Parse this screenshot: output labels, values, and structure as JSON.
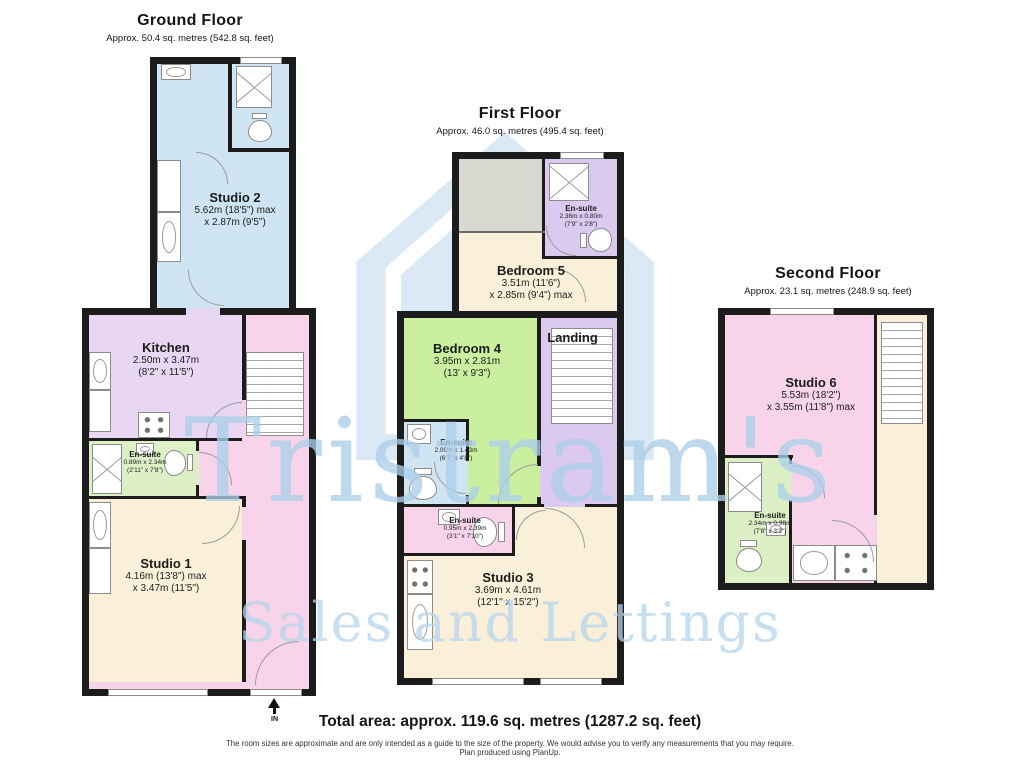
{
  "watermark": {
    "brand": "Tristram's",
    "tagline": "Sales and Lettings",
    "color": "#cde2f3"
  },
  "floors": {
    "ground": {
      "title": "Ground Floor",
      "subtitle": "Approx. 50.4 sq. metres (542.8 sq. feet)",
      "entrance_label": "IN",
      "rooms": {
        "studio2": {
          "name": "Studio 2",
          "dims1": "5.62m (18'5\") max",
          "dims2": "x 2.87m (9'5\")"
        },
        "kitchen": {
          "name": "Kitchen",
          "dims1": "2.50m x 3.47m",
          "dims2": "(8'2\" x 11'5\")"
        },
        "ensuite": {
          "name": "En-suite",
          "dims1": "0.89m x 2.34m",
          "dims2": "(2'11\" x 7'8\")"
        },
        "studio1": {
          "name": "Studio 1",
          "dims1": "4.16m (13'8\") max",
          "dims2": "x 3.47m (11'5\")"
        }
      }
    },
    "first": {
      "title": "First Floor",
      "subtitle": "Approx. 46.0 sq. metres (495.4 sq. feet)",
      "rooms": {
        "ensuite_top": {
          "name": "En-suite",
          "dims1": "2.36m x 0.80m",
          "dims2": "(7'9\" x 2'8\")"
        },
        "bedroom5": {
          "name": "Bedroom 5",
          "dims1": "3.51m (11'6\")",
          "dims2": "x 2.85m (9'4\") max"
        },
        "bedroom4": {
          "name": "Bedroom 4",
          "dims1": "3.95m x 2.81m",
          "dims2": "(13' x 9'3\")"
        },
        "landing": {
          "name": "Landing"
        },
        "ensuite_mid": {
          "name": "En-suite",
          "dims1": "2.00m x 1.43m",
          "dims2": "(6'7\" x 4'8\")"
        },
        "ensuite_low": {
          "name": "En-suite",
          "dims1": "0.95m x 2.39m",
          "dims2": "(3'1\" x 7'10\")"
        },
        "studio3": {
          "name": "Studio 3",
          "dims1": "3.69m x 4.61m",
          "dims2": "(12'1\" x 15'2\")"
        }
      }
    },
    "second": {
      "title": "Second Floor",
      "subtitle": "Approx. 23.1 sq. metres (248.9 sq. feet)",
      "rooms": {
        "studio6": {
          "name": "Studio 6",
          "dims1": "5.53m (18'2\")",
          "dims2": "x 3.55m (11'8\") max"
        },
        "ensuite": {
          "name": "En-suite",
          "dims1": "2.34m x 0.98m",
          "dims2": "(7'8\" x 3'3\")"
        }
      }
    }
  },
  "footer": {
    "total": "Total area: approx. 119.6 sq. metres (1287.2 sq. feet)",
    "disclaimer": "The room sizes are approximate and are only intended as a guide to the size of the property. We would advise you to verify any measurements that you may require.",
    "produced": "Plan produced using PlanUp."
  },
  "palette": {
    "studio_blue": "#cfe5f3",
    "kitchen_lavender": "#e8d6f2",
    "ensuite_green": "#dcefc5",
    "cream": "#faf0d9",
    "hall_pink": "#f7d4e9",
    "bedroom_green": "#c9ef9f",
    "landing_lavender": "#dbc9ef",
    "void_grey": "#d8d8d1",
    "wall": "#1c1c1c",
    "watermark_blue": "#cde2f3"
  },
  "icons": {
    "shower": "crossed-square-shower-tray",
    "toilet": "wc-pan-with-cistern",
    "sink": "oval-basin",
    "hob": "four-burner-hob",
    "stairs": "tread-lines",
    "door": "quarter-circle-swing",
    "entrance": "up-arrow"
  }
}
